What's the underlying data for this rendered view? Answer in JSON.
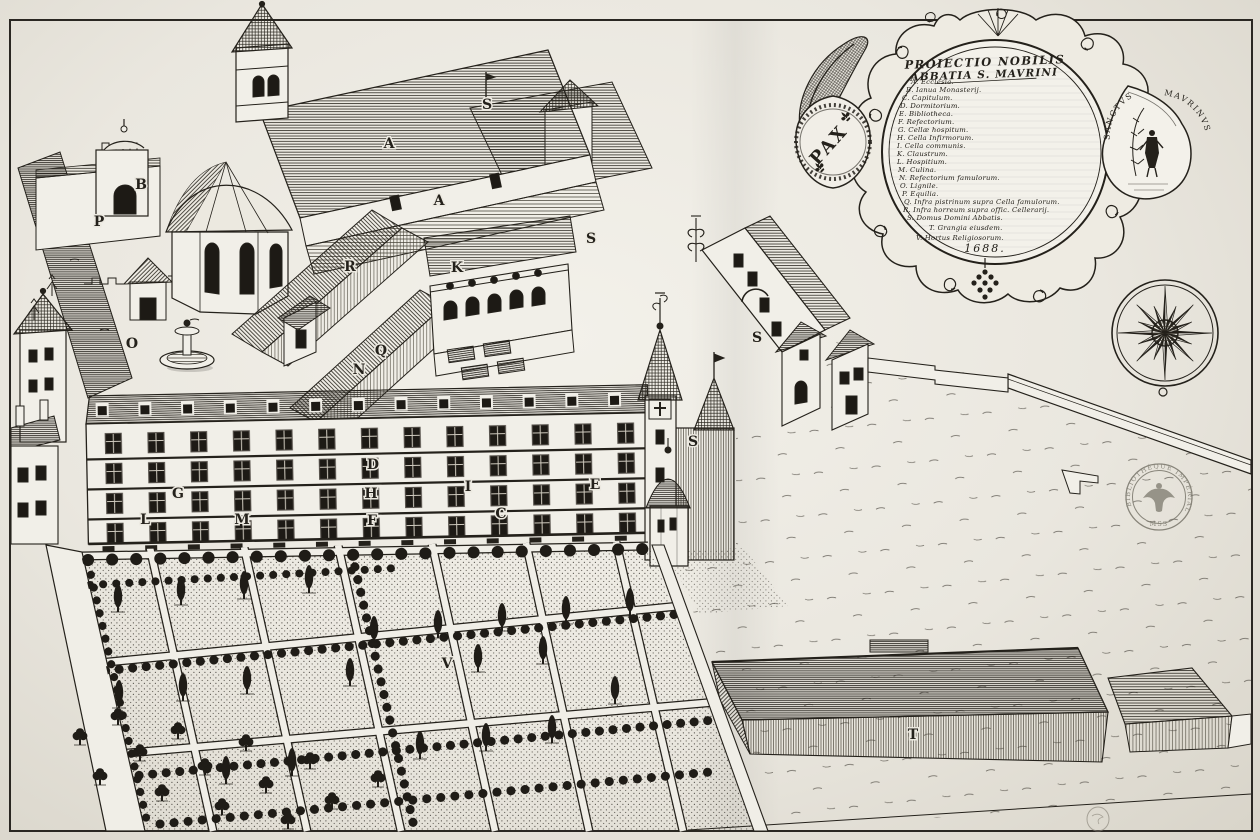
{
  "cartouche": {
    "title_line1": "PROIECTIO NOBILIS",
    "title_line2": "ABBATIA S. MAVRINI",
    "date": "1688.",
    "pax": "PAX",
    "saint_left": "SANCTVS",
    "saint_right": "MAVRINVS",
    "legend": [
      {
        "key": "A",
        "label": "Ecclesia."
      },
      {
        "key": "B",
        "label": "Ianua Monasterij."
      },
      {
        "key": "C",
        "label": "Capitulum."
      },
      {
        "key": "D",
        "label": "Dormitorium."
      },
      {
        "key": "E",
        "label": "Bibliotheca."
      },
      {
        "key": "F",
        "label": "Refectorium."
      },
      {
        "key": "G",
        "label": "Cellæ hospitum."
      },
      {
        "key": "H",
        "label": "Cella Infirmorum."
      },
      {
        "key": "I",
        "label": "Cella communis."
      },
      {
        "key": "K",
        "label": "Claustrum."
      },
      {
        "key": "L",
        "label": "Hospitium."
      },
      {
        "key": "M",
        "label": "Culina."
      },
      {
        "key": "N",
        "label": "Refectorium famulorum."
      },
      {
        "key": "O",
        "label": "Lignile."
      },
      {
        "key": "P",
        "label": "Equilia."
      },
      {
        "key": "Q",
        "label": "Infra pistrinum supra Cella famulorum."
      },
      {
        "key": "R",
        "label": "Infra horreum supra offic. Cellerarij."
      },
      {
        "key": "S",
        "label": "Domus Domini Abbatis."
      },
      {
        "key": "T",
        "label": "Grangia eiusdem."
      },
      {
        "key": "V",
        "label": "Hortus Religiosorum."
      }
    ]
  },
  "map_labels": [
    {
      "char": "A",
      "x": 389,
      "y": 143
    },
    {
      "char": "S",
      "x": 487,
      "y": 104
    },
    {
      "char": "A",
      "x": 439,
      "y": 200
    },
    {
      "char": "B",
      "x": 141,
      "y": 184
    },
    {
      "char": "P",
      "x": 99,
      "y": 221
    },
    {
      "char": "R",
      "x": 350,
      "y": 266
    },
    {
      "char": "K",
      "x": 457,
      "y": 267
    },
    {
      "char": "S",
      "x": 591,
      "y": 238
    },
    {
      "char": "O",
      "x": 132,
      "y": 343
    },
    {
      "char": "Q",
      "x": 381,
      "y": 350
    },
    {
      "char": "N",
      "x": 359,
      "y": 369
    },
    {
      "char": "S",
      "x": 757,
      "y": 337
    },
    {
      "char": "S",
      "x": 693,
      "y": 441
    },
    {
      "char": "D",
      "x": 373,
      "y": 464
    },
    {
      "char": "G",
      "x": 178,
      "y": 493
    },
    {
      "char": "H",
      "x": 371,
      "y": 493
    },
    {
      "char": "I",
      "x": 468,
      "y": 486
    },
    {
      "char": "E",
      "x": 595,
      "y": 484
    },
    {
      "char": "L",
      "x": 145,
      "y": 519
    },
    {
      "char": "M",
      "x": 242,
      "y": 519
    },
    {
      "char": "F",
      "x": 372,
      "y": 520
    },
    {
      "char": "C",
      "x": 501,
      "y": 513
    },
    {
      "char": "V",
      "x": 447,
      "y": 663
    },
    {
      "char": "T",
      "x": 913,
      "y": 734
    }
  ],
  "stamp": {
    "arc": "BIBLIOTHÈQUE IMPÉRIALE",
    "bottom": "MSS"
  },
  "colors": {
    "ink": "#24211b",
    "paper": "#f1efe8"
  }
}
